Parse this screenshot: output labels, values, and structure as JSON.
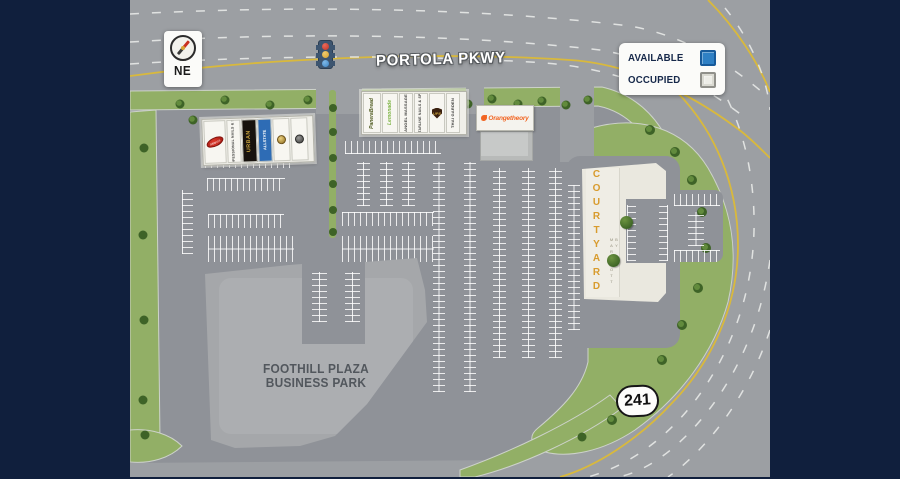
{
  "page": {
    "background": "#101F3D"
  },
  "legend": {
    "available_label": "AVAILABLE",
    "occupied_label": "OCCUPIED",
    "available_color": "#2F80C4",
    "occupied_color": "#EDEDE7"
  },
  "compass": {
    "direction": "NE"
  },
  "roads": {
    "main_label": "PORTOLA PKWY",
    "route_shield": "241",
    "yellow_line_color": "#D9B93C"
  },
  "business_park": {
    "line1": "FOOTHILL PLAZA",
    "line2": "BUSINESS PARK"
  },
  "hotel": {
    "name": "COURTYARD",
    "subtitle": "BY MARRIOTT",
    "accent_color": "#D89B2D"
  },
  "buildings": {
    "west_shops": {
      "tenants": [
        {
          "label": "Milano's",
          "logo": "red-oval"
        },
        {
          "label": "PROFESSIONAL NAILS & SPA"
        },
        {
          "label": "URBAN"
        },
        {
          "label": "ALLSTATE"
        },
        {
          "label": "",
          "logo": "round-badge-gold"
        },
        {
          "label": "",
          "logo": "round-badge-dark"
        }
      ]
    },
    "north_shops": {
      "tenants": [
        {
          "label": "PaneraBread"
        },
        {
          "label": "Lemonade"
        },
        {
          "label": "ANGEL MASSAGE"
        },
        {
          "label": "STARLINE NAILS & SPA"
        },
        {
          "label": "UPS"
        },
        {
          "label": "THAI GARDEN"
        }
      ]
    },
    "fitness_pad": {
      "tenant": "Orangetheory",
      "accent_color": "#F26522"
    }
  }
}
